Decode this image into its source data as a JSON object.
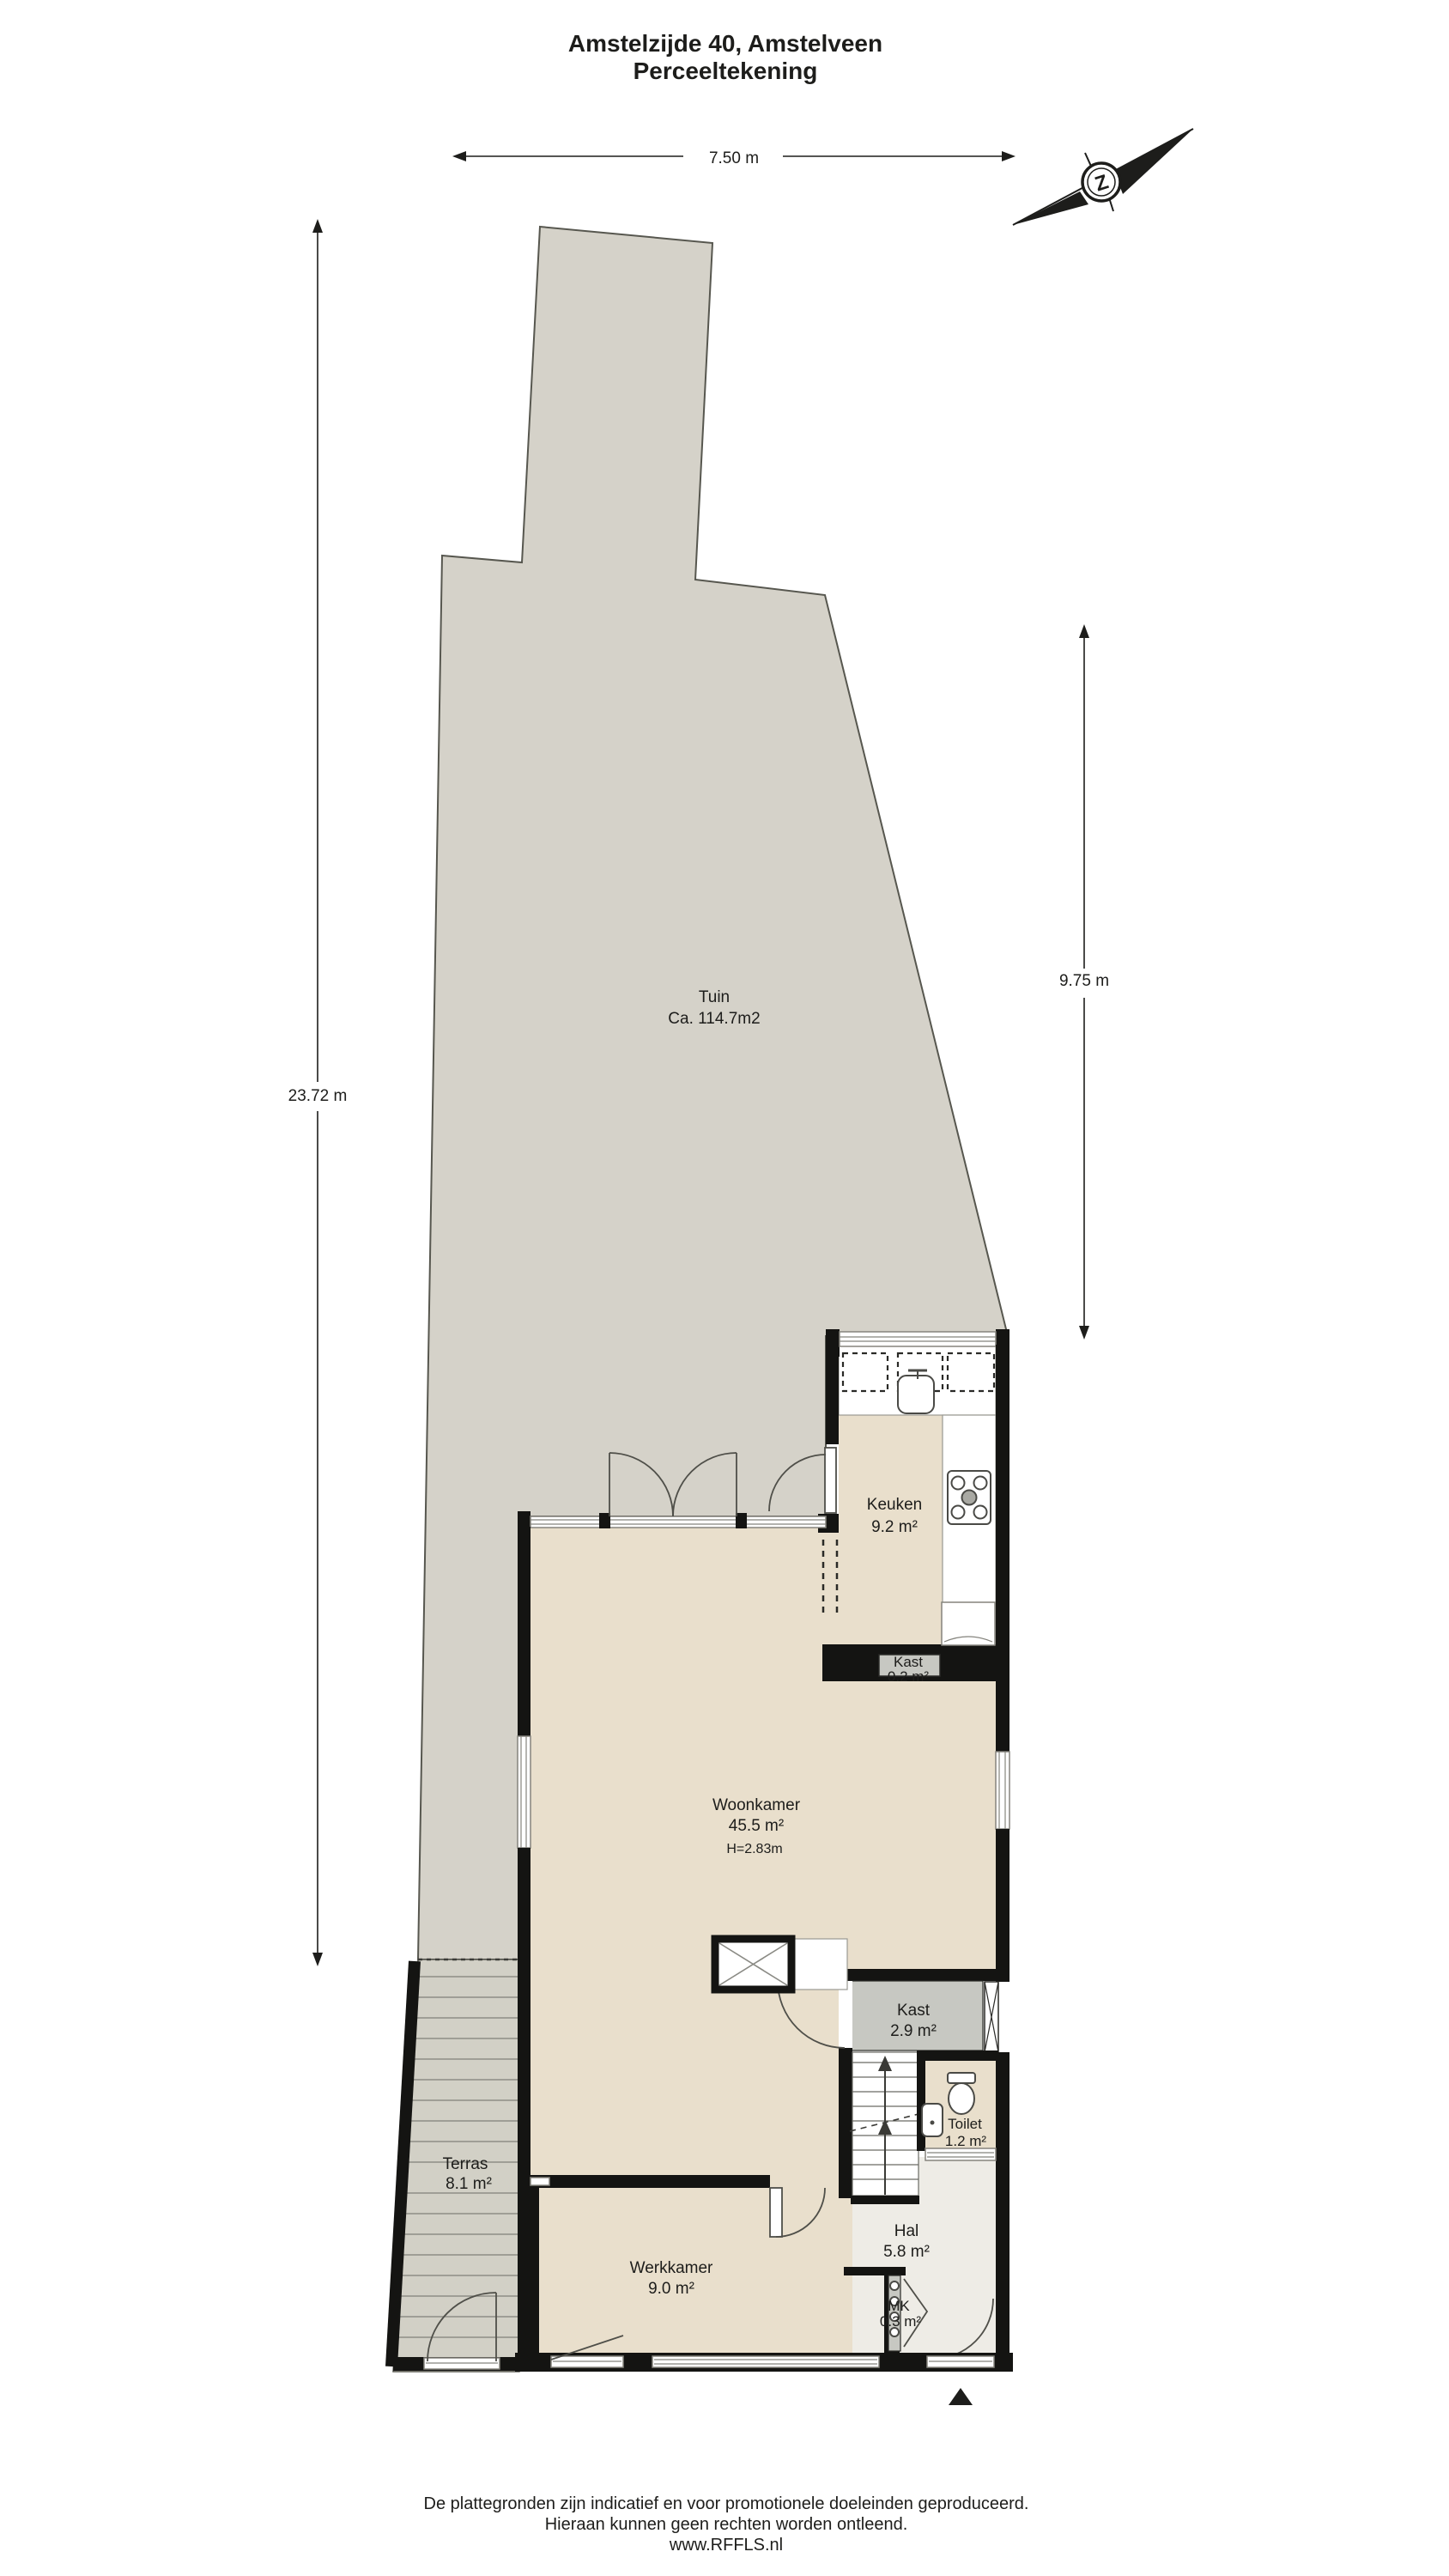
{
  "header": {
    "title_line1": "Amstelzijde 40, Amstelveen",
    "title_line2": "Perceeltekening"
  },
  "dimensions": {
    "plot_width": "7.50 m",
    "plot_depth": "23.72 m",
    "garden_depth": "9.75 m"
  },
  "compass": {
    "north_letter": "Z"
  },
  "rooms": {
    "tuin": {
      "name": "Tuin",
      "area": "Ca. 114.7m2"
    },
    "keuken": {
      "name": "Keuken",
      "area": "9.2 m²"
    },
    "kast_klein": {
      "name": "Kast",
      "area": "0.2 m²"
    },
    "woonkamer": {
      "name": "Woonkamer",
      "area": "45.5 m²",
      "height": "H=2.83m"
    },
    "kast_groot": {
      "name": "Kast",
      "area": "2.9 m²"
    },
    "toilet": {
      "name": "Toilet",
      "area": "1.2 m²"
    },
    "terras": {
      "name": "Terras",
      "area": "8.1 m²"
    },
    "werkkamer": {
      "name": "Werkkamer",
      "area": "9.0 m²"
    },
    "hal": {
      "name": "Hal",
      "area": "5.8 m²"
    },
    "meterkast": {
      "name": "MK",
      "area": "0.3 m²"
    }
  },
  "footer": {
    "line1": "De plattegronden zijn indicatief en voor promotionele doeleinden geproduceerd.",
    "line2": "Hieraan kunnen geen rechten worden ontleend.",
    "line3": "www.RFFLS.nl"
  },
  "colors": {
    "garden": "#d5d2c9",
    "terrace": "#d2d0c6",
    "floor": "#e9dfcc",
    "hall_floor": "#eeece6",
    "closet": "#c7c8c2",
    "wall": "#141412",
    "text": "#1d1d1b"
  }
}
